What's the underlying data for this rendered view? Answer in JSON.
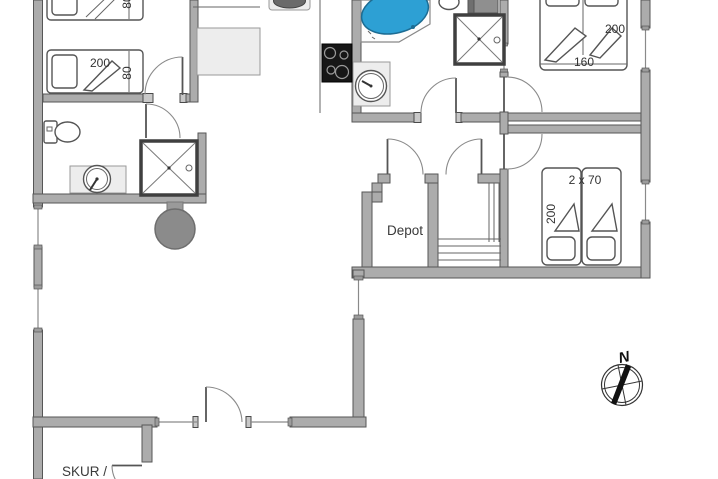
{
  "document": {
    "type": "floor-plan",
    "orientation_marker": "compass-rose"
  },
  "labels": {
    "bed_tl_top_width": "80",
    "bed_tl_length": "200",
    "bed_tl_width": "80",
    "bed_tr_length": "200",
    "bed_tr_width": "160",
    "bed_br_size": "2 x 70",
    "bed_br_length": "200",
    "depot": "Depot",
    "skur": "SKUR /",
    "compass_north": "N"
  },
  "colors": {
    "wall_fill": "#acacac",
    "wall_edge": "#565656",
    "spa_blue": "#2da0d4",
    "spa_blue_edge": "#1c6c93",
    "hob_black": "#161616",
    "wood_stove_gray": "#8b8b8b",
    "light_fixture_fill": "#ededed",
    "line": "#555555"
  },
  "fixtures": [
    "single-bed",
    "single-bed",
    "double-bed",
    "twin-beds",
    "toilet",
    "washbasin",
    "shower-cabin",
    "shower-cabin",
    "corner-spa-bath",
    "washing-machine",
    "kitchen-sink",
    "cooktop-hob",
    "kitchen-counter",
    "table",
    "wood-stove",
    "wardrobe-cabinet",
    "shelving-stairs",
    "compass-rose"
  ]
}
